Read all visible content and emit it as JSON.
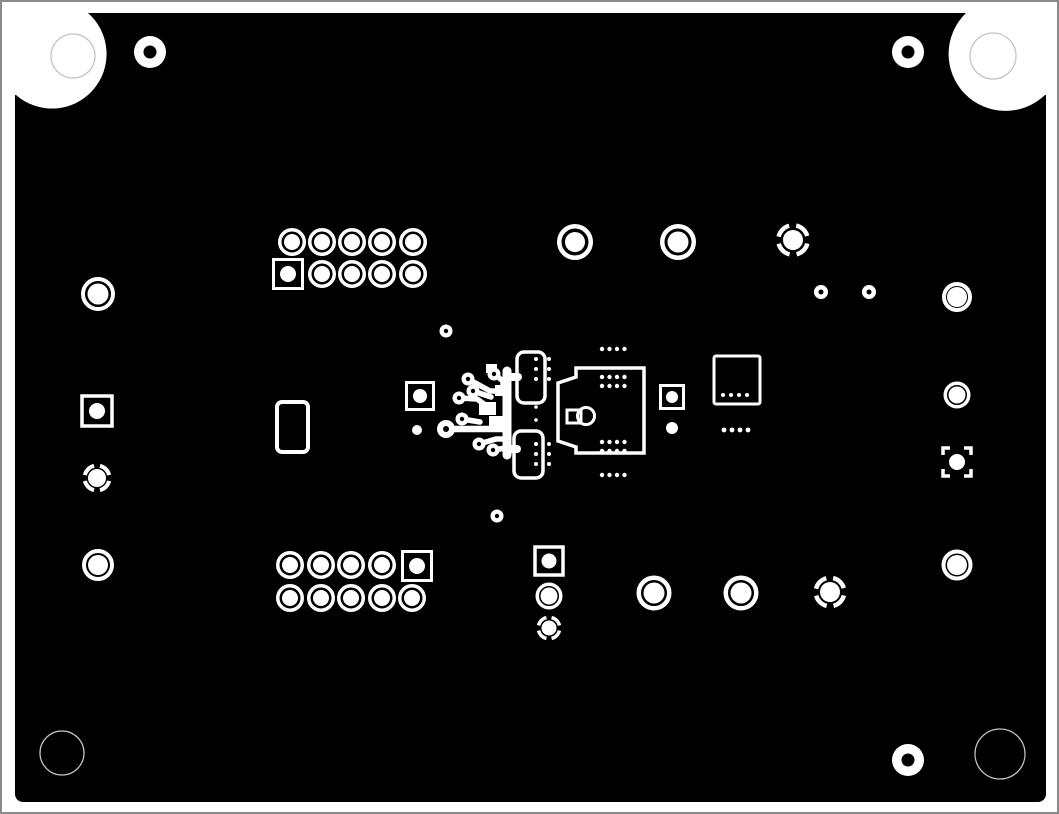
{
  "canvas": {
    "width": 1059,
    "height": 814,
    "page_bg": "#ffffff",
    "frame_color": "#8a8a8a",
    "board_color": "#000000",
    "pad_color": "#ffffff",
    "faint_color": "#c4c4c4"
  },
  "board": {
    "x": 15,
    "y": 13,
    "w": 1031,
    "h": 789,
    "rx": 8
  },
  "corner_cutouts": [
    {
      "name": "top-left",
      "path": "M 15 13 L 88 13 A 50 50 0 0 1 16 95 L 15 95 Z",
      "drill": {
        "cx": 73,
        "cy": 56,
        "r": 22
      }
    },
    {
      "name": "top-right",
      "path": "M 1046 13 L 966 13 A 50 50 0 0 0 1045 95 L 1046 95 Z",
      "drill": {
        "cx": 993,
        "cy": 56,
        "r": 23
      }
    },
    {
      "name": "bottom-left",
      "path": "M 15 719 A 50 50 0 0 0 89 802 L 15 802 Z",
      "drill": {
        "cx": 62,
        "cy": 753,
        "r": 22
      }
    },
    {
      "name": "bottom-right",
      "path": "M 1046 719 A 50 50 0 0 1 970 802 L 1046 802 Z",
      "drill": {
        "cx": 1000,
        "cy": 754,
        "r": 25
      }
    }
  ],
  "donut_pads": [
    {
      "cx": 150,
      "cy": 52,
      "ro": 16,
      "hole": 6.5
    },
    {
      "cx": 908,
      "cy": 52,
      "ro": 16,
      "hole": 6.5
    },
    {
      "cx": 908,
      "cy": 760,
      "ro": 16,
      "hole": 6.5
    },
    {
      "cx": 821,
      "cy": 292,
      "ro": 7,
      "hole": 2.5
    },
    {
      "cx": 869,
      "cy": 292,
      "ro": 7,
      "hole": 2.5
    },
    {
      "cx": 446,
      "cy": 331,
      "ro": 6.5,
      "hole": 2.2
    },
    {
      "cx": 497,
      "cy": 516,
      "ro": 6.5,
      "hole": 2.2
    }
  ],
  "plain_dots": [
    {
      "cx": 417,
      "cy": 430,
      "r": 5
    },
    {
      "cx": 672,
      "cy": 428,
      "r": 6
    }
  ],
  "ring_pads": [
    {
      "cx": 575,
      "cy": 242,
      "ro": 18,
      "rw": 4.5,
      "rc": 10
    },
    {
      "cx": 678,
      "cy": 242,
      "ro": 18,
      "rw": 4.5,
      "rc": 10.5
    },
    {
      "cx": 98,
      "cy": 294,
      "ro": 17,
      "rw": 4,
      "rc": 10.5
    },
    {
      "cx": 957,
      "cy": 297,
      "ro": 15,
      "rw": 4,
      "rc": 10
    },
    {
      "cx": 957,
      "cy": 395,
      "ro": 13.5,
      "rw": 3.5,
      "rc": 8.5
    },
    {
      "cx": 98,
      "cy": 565,
      "ro": 16,
      "rw": 4,
      "rc": 10
    },
    {
      "cx": 957,
      "cy": 565,
      "ro": 15.5,
      "rw": 4,
      "rc": 10
    },
    {
      "cx": 549,
      "cy": 596,
      "ro": 13.5,
      "rw": 3.5,
      "rc": 8.5
    },
    {
      "cx": 654,
      "cy": 593,
      "ro": 17.5,
      "rw": 4.5,
      "rc": 10.5
    },
    {
      "cx": 741,
      "cy": 593,
      "ro": 17.5,
      "rw": 4.5,
      "rc": 10.5
    }
  ],
  "dashed_ring_pads": [
    {
      "cx": 793,
      "cy": 240,
      "ro": 17,
      "rw": 4.5,
      "rc": 10
    },
    {
      "cx": 97,
      "cy": 478,
      "ro": 14.5,
      "rw": 4,
      "rc": 9
    },
    {
      "cx": 549,
      "cy": 628,
      "ro": 12.5,
      "rw": 3.5,
      "rc": 7.5
    },
    {
      "cx": 830,
      "cy": 592,
      "ro": 16.5,
      "rw": 4.5,
      "rc": 10
    }
  ],
  "square_pads": [
    {
      "cx": 97,
      "cy": 411,
      "size": 30,
      "stroke": 3.5,
      "rc": 8,
      "bracket": false
    },
    {
      "cx": 420,
      "cy": 396,
      "size": 27,
      "stroke": 3,
      "rc": 7,
      "bracket": false
    },
    {
      "cx": 672,
      "cy": 397,
      "size": 23,
      "stroke": 3,
      "rc": 6,
      "bracket": false
    },
    {
      "cx": 549,
      "cy": 561,
      "size": 28,
      "stroke": 3.5,
      "rc": 7.5,
      "bracket": false
    },
    {
      "cx": 957,
      "cy": 462,
      "size": 28,
      "stroke": 3.5,
      "rc": 8,
      "bracket": true
    }
  ],
  "via_groups": [
    {
      "cols": [
        292,
        322,
        352,
        382,
        413
      ],
      "rows": [
        242,
        274
      ],
      "square_cell": {
        "row": 1,
        "col": 0,
        "cx": 288,
        "cy": 274
      },
      "ring": {
        "ro": 14,
        "rw": 3.5,
        "rc": 8
      },
      "sq": {
        "size": 29,
        "stroke": 3,
        "rc": 8
      }
    },
    {
      "cols": [
        290,
        321,
        351,
        382,
        412
      ],
      "rows": [
        565,
        598
      ],
      "square_cell": {
        "row": 0,
        "col": 4,
        "cx": 417,
        "cy": 566
      },
      "ring": {
        "ro": 14,
        "rw": 3.5,
        "rc": 8
      },
      "sq": {
        "size": 29,
        "stroke": 3,
        "rc": 8
      }
    }
  ],
  "outline_rects": [
    {
      "x": 277,
      "y": 402,
      "w": 31,
      "h": 50,
      "rx": 5,
      "stroke": 4
    },
    {
      "x": 714,
      "y": 356,
      "w": 46,
      "h": 48,
      "rx": 2,
      "stroke": 3
    },
    {
      "x": 517,
      "y": 352,
      "w": 28,
      "h": 51,
      "rx": 7,
      "stroke": 3.5
    },
    {
      "x": 514,
      "y": 431,
      "w": 29,
      "h": 47,
      "rx": 7,
      "stroke": 3.5
    }
  ],
  "connector": {
    "path": "M 576 368 L 644 368 L 644 453 L 576 453 L 576 447 L 558 441 L 558 383 L 576 377 Z",
    "stroke": 3.5,
    "key_rect": {
      "x": 567,
      "y": 410,
      "w": 14,
      "h": 13,
      "stroke": 3
    },
    "key_circle": {
      "cx": 586,
      "cy": 416,
      "r": 8.5,
      "stroke": 3
    }
  },
  "dot_grids": [
    {
      "x": 602,
      "y": 349,
      "cols": 4,
      "rows": 1,
      "px": 7.5,
      "py": 0,
      "r": 2.2
    },
    {
      "x": 602,
      "y": 377,
      "cols": 4,
      "rows": 2,
      "px": 7.5,
      "py": 9,
      "r": 2.2
    },
    {
      "x": 602,
      "y": 442,
      "cols": 4,
      "rows": 2,
      "px": 7.5,
      "py": 9,
      "r": 2.2
    },
    {
      "x": 602,
      "y": 475,
      "cols": 4,
      "rows": 1,
      "px": 7.5,
      "py": 0,
      "r": 2.2
    },
    {
      "x": 536,
      "y": 359,
      "cols": 1,
      "rows": 3,
      "px": 0,
      "py": 10,
      "r": 2
    },
    {
      "x": 549,
      "y": 359,
      "cols": 1,
      "rows": 3,
      "px": 0,
      "py": 10,
      "r": 2
    },
    {
      "x": 536,
      "y": 444,
      "cols": 1,
      "rows": 3,
      "px": 0,
      "py": 10,
      "r": 2
    },
    {
      "x": 549,
      "y": 444,
      "cols": 1,
      "rows": 3,
      "px": 0,
      "py": 10,
      "r": 2
    },
    {
      "x": 536,
      "y": 407,
      "cols": 1,
      "rows": 2,
      "px": 0,
      "py": 13,
      "r": 1.8
    },
    {
      "x": 723,
      "y": 395,
      "cols": 4,
      "rows": 1,
      "px": 8,
      "py": 0,
      "r": 2
    },
    {
      "x": 724,
      "y": 430,
      "cols": 4,
      "rows": 1,
      "px": 8,
      "py": 0,
      "r": 2.4
    }
  ],
  "trace_cluster": {
    "traces": [
      {
        "pts": [
          [
            468,
            379
          ],
          [
            490,
            391
          ],
          [
            504,
            391
          ]
        ],
        "w": 5.5
      },
      {
        "pts": [
          [
            494,
            374
          ],
          [
            503,
            381
          ],
          [
            503,
            391
          ]
        ],
        "w": 5.5
      },
      {
        "pts": [
          [
            459,
            398
          ],
          [
            477,
            399
          ],
          [
            484,
            404
          ]
        ],
        "w": 5.5
      },
      {
        "pts": [
          [
            473,
            391
          ],
          [
            491,
            397
          ]
        ],
        "w": 5.5
      },
      {
        "pts": [
          [
            462,
            419
          ],
          [
            480,
            422
          ]
        ],
        "w": 5.5
      },
      {
        "pts": [
          [
            446,
            429
          ],
          [
            507,
            429
          ]
        ],
        "w": 6.5
      },
      {
        "pts": [
          [
            479,
            444
          ],
          [
            496,
            439
          ],
          [
            506,
            439
          ]
        ],
        "w": 5.5
      },
      {
        "pts": [
          [
            493,
            450
          ],
          [
            506,
            448
          ]
        ],
        "w": 5.5
      },
      {
        "pts": [
          [
            507,
            371
          ],
          [
            507,
            455
          ]
        ],
        "w": 9
      },
      {
        "pts": [
          [
            507,
            377
          ],
          [
            518,
            377
          ]
        ],
        "w": 8
      },
      {
        "pts": [
          [
            507,
            449
          ],
          [
            517,
            449
          ]
        ],
        "w": 8
      }
    ],
    "fill_rects": [
      {
        "x": 479,
        "y": 402,
        "w": 17,
        "h": 13
      },
      {
        "x": 489,
        "y": 416,
        "w": 15,
        "h": 11
      },
      {
        "x": 495,
        "y": 385,
        "w": 13,
        "h": 11
      },
      {
        "x": 486,
        "y": 364,
        "w": 11,
        "h": 9
      }
    ],
    "pads": [
      {
        "cx": 446,
        "cy": 429,
        "ro": 9,
        "hole": 3
      },
      {
        "cx": 468,
        "cy": 379,
        "ro": 6.5,
        "hole": 2.2
      },
      {
        "cx": 494,
        "cy": 374,
        "ro": 6.5,
        "hole": 2.2
      },
      {
        "cx": 459,
        "cy": 398,
        "ro": 6.5,
        "hole": 2.2
      },
      {
        "cx": 473,
        "cy": 391,
        "ro": 6.5,
        "hole": 2.2
      },
      {
        "cx": 462,
        "cy": 419,
        "ro": 6.5,
        "hole": 2.2
      },
      {
        "cx": 479,
        "cy": 444,
        "ro": 6.5,
        "hole": 2.2
      },
      {
        "cx": 493,
        "cy": 450,
        "ro": 6.5,
        "hole": 2.2
      }
    ]
  }
}
